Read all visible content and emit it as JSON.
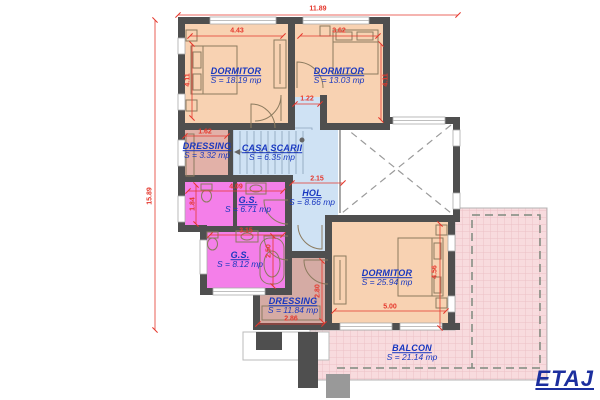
{
  "plan_label": "ETAJ",
  "rooms": [
    {
      "id": "dormitor-1",
      "name": "DORMITOR",
      "area": "S = 18.19 mp"
    },
    {
      "id": "dormitor-2",
      "name": "DORMITOR",
      "area": "S = 13.03 mp"
    },
    {
      "id": "dressing-1",
      "name": "DRESSING",
      "area": "S = 3.32 mp"
    },
    {
      "id": "casa-scarii",
      "name": "CASA SCARII",
      "area": "S = 6.35 mp"
    },
    {
      "id": "gs-1",
      "name": "G.S.",
      "area": "S = 6.71 mp"
    },
    {
      "id": "hol",
      "name": "HOL",
      "area": "S = 8.66 mp"
    },
    {
      "id": "gs-2",
      "name": "G.S.",
      "area": "S = 8.12 mp"
    },
    {
      "id": "dormitor-3",
      "name": "DORMITOR",
      "area": "S = 25.94 mp"
    },
    {
      "id": "dressing-2",
      "name": "DRESSING",
      "area": "S = 11.84 mp"
    },
    {
      "id": "balcon",
      "name": "BALCON",
      "area": "S = 21.14 mp"
    }
  ],
  "dimensions": {
    "overall_width": "11.89",
    "overall_height": "15.89",
    "dormitor1_width": "4.43",
    "dormitor2_width": "3.62",
    "dormitor1_depth": "4.11",
    "dormitor2_depth": "4.11",
    "passage_width": "1.22",
    "dressing1_width": "1.62",
    "hol_width": "2.15",
    "gs1_width": "4.09",
    "gs1_depth": "1.84",
    "gs2_width": "3.15",
    "gs2_depth": "2.50",
    "dressing2_depth": "2.80",
    "dressing2_width": "2.86",
    "dormitor3_width": "5.00",
    "dormitor3_depth": "4.56"
  },
  "colors": {
    "bedroom_fill": "#f8d2b2",
    "dressing1_fill": "#e2b1a8",
    "hall_fill": "#cfe2f4",
    "bathroom_fill": "#f47fe9",
    "dressing2_fill": "#d5aba4",
    "balcony_fill": "#f8dbde",
    "wall": "#4f4f4f",
    "dimension_red": "#e5372c",
    "label_blue": "#1837c0",
    "title_blue": "#1c2f9e"
  }
}
